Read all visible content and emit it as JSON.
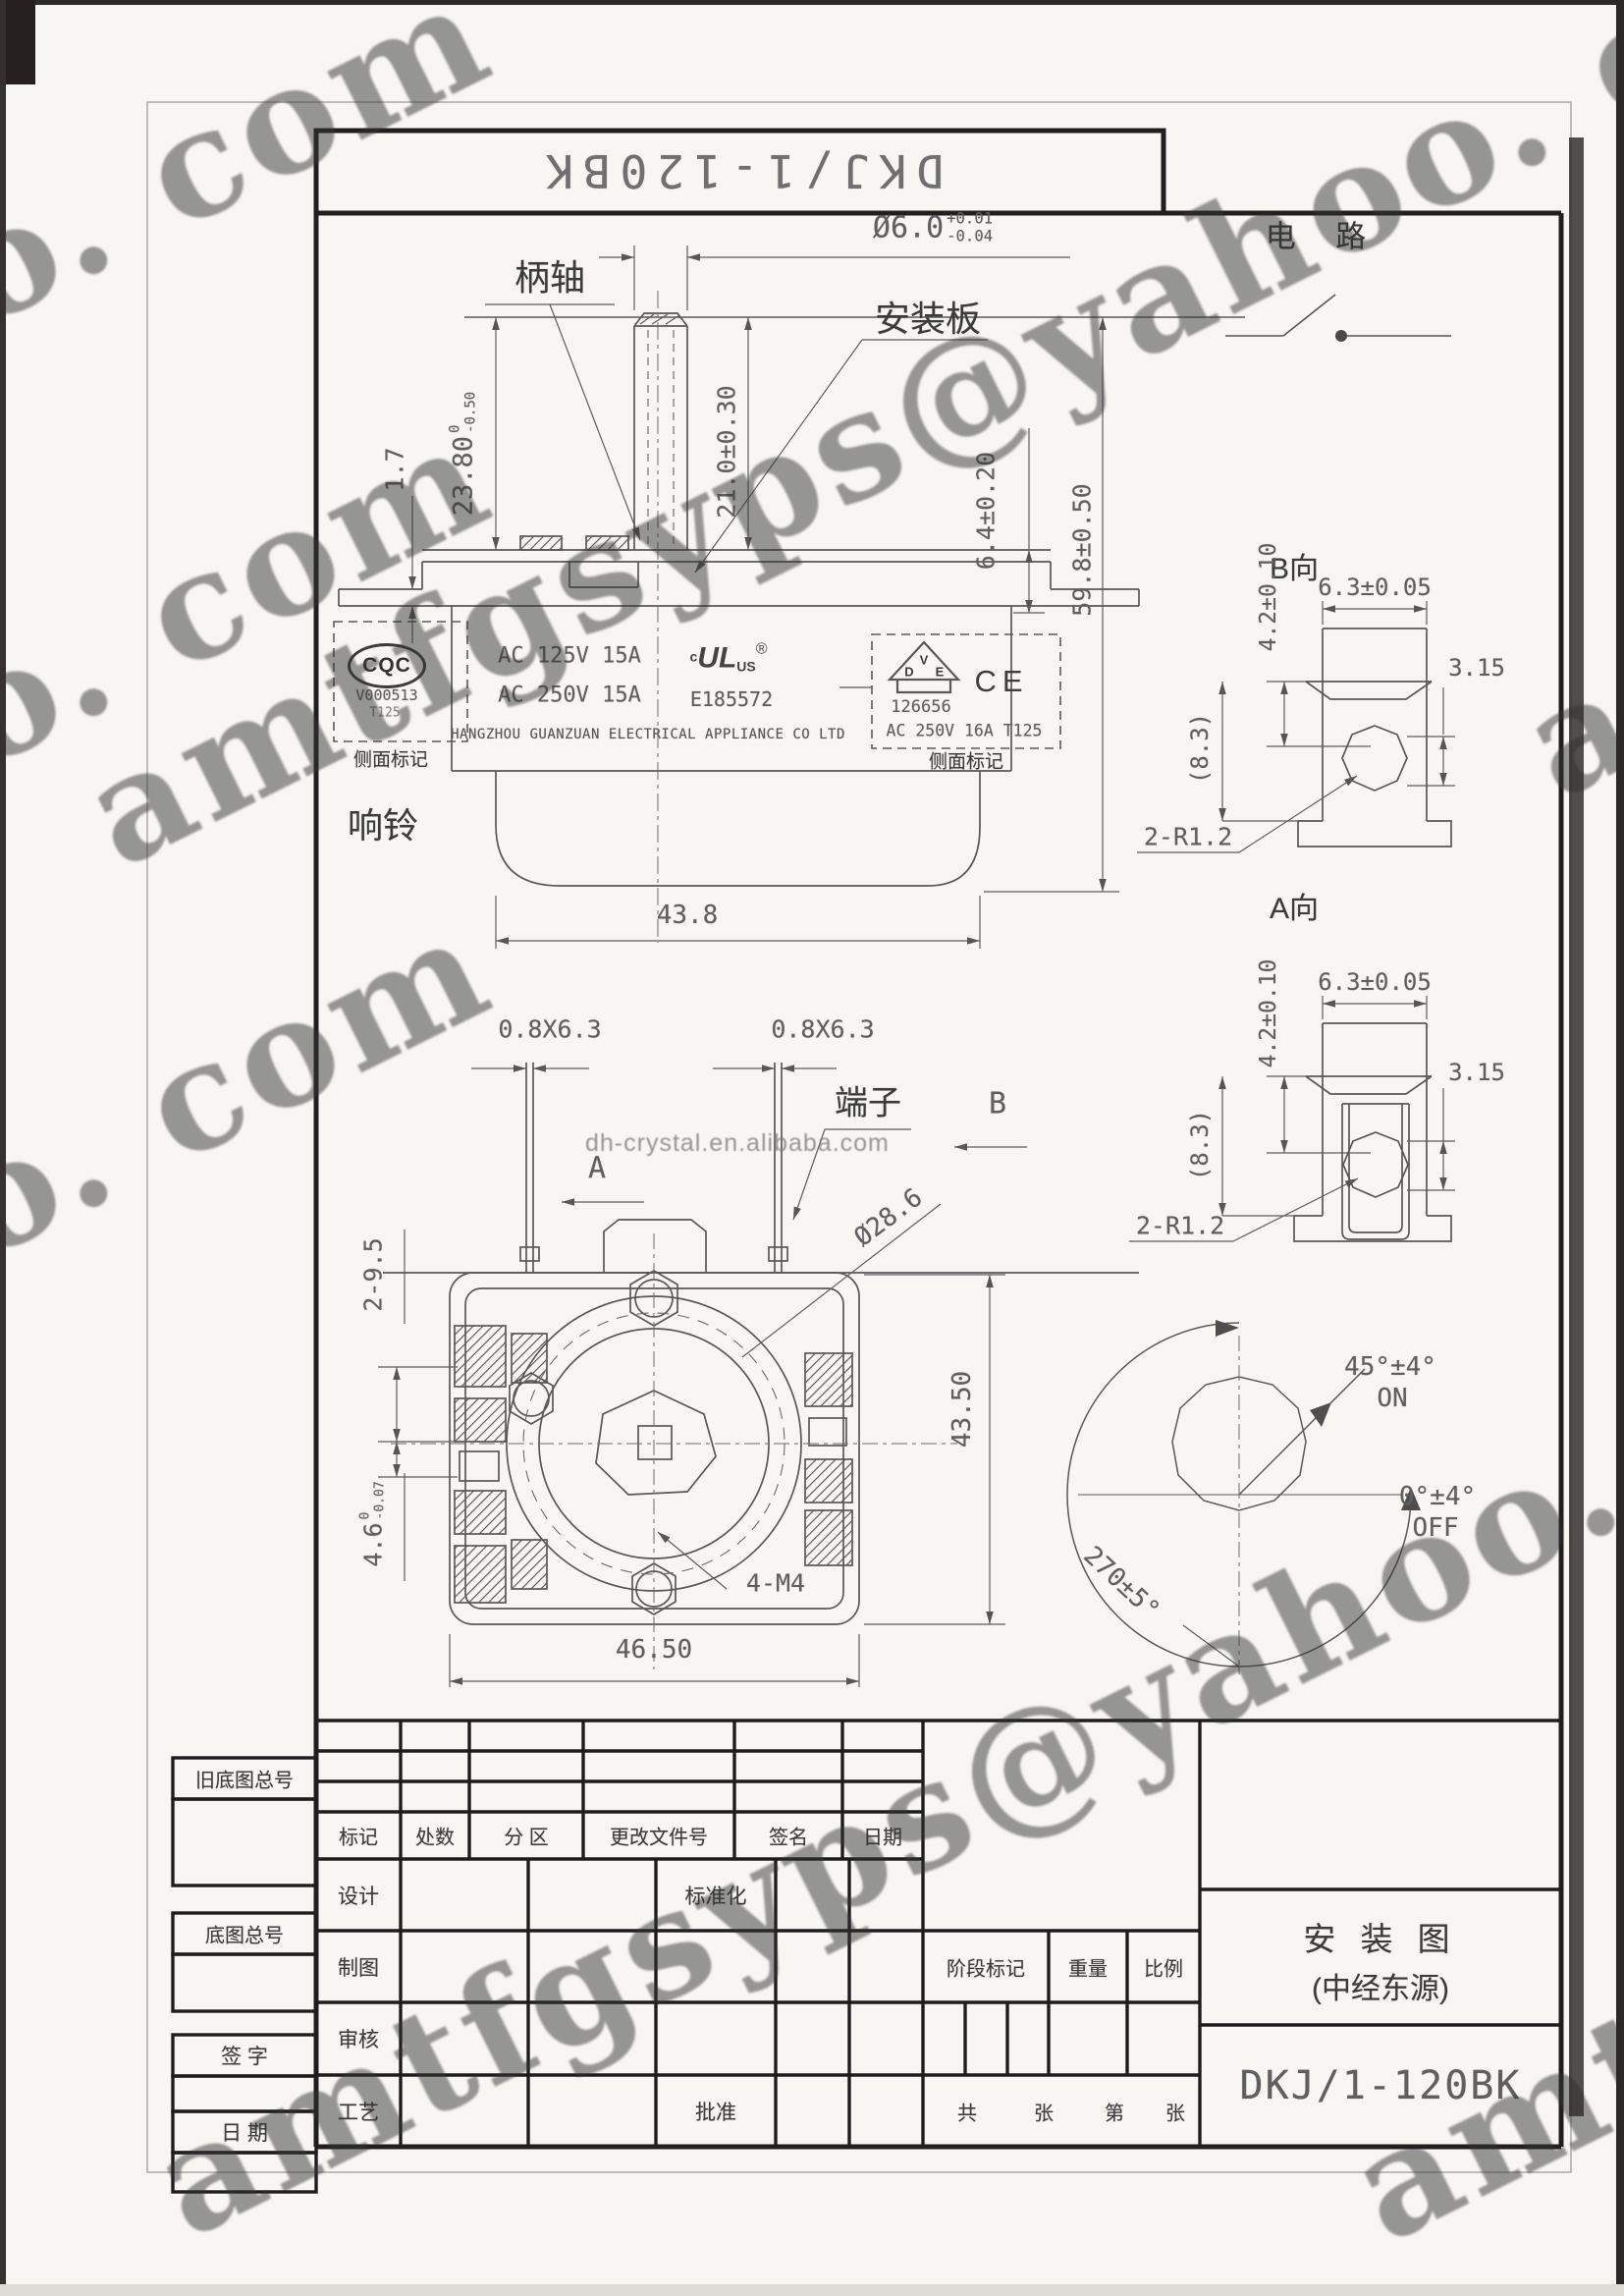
{
  "watermark": {
    "email": "amtfgsyps@yahoo. com",
    "alibaba": "dh-crystal.en.alibaba.com"
  },
  "top_bar": {
    "part_no": "DKJ/1-120BK"
  },
  "circuit": {
    "label": "电  路"
  },
  "side_view": {
    "handle_shaft_label": "柄轴",
    "mounting_plate_label": "安装板",
    "bell_label": "响铃",
    "shaft_dia": {
      "main": "Ø6.0",
      "plus": "+0.01",
      "minus": "-0.04"
    },
    "shaft_len": {
      "main": "23.80",
      "plus": "0",
      "minus": "-0.50"
    },
    "plate_thickness": "1.7",
    "dim_21": "21.0±0.30",
    "dim_64": "6.4±0.20",
    "dim_598": "59.8±0.50",
    "dim_438": "43.8",
    "cqc": {
      "logo": "CQC",
      "cert_no": "V000513",
      "t_rating": "T125",
      "side_mark_label": "侧面标记"
    },
    "ratings": {
      "line1": "AC 125V 15A",
      "line2": "AC 250V 15A"
    },
    "ul": {
      "c": "c",
      "logo": "UL",
      "us": "US",
      "reg": "®",
      "file_no": "E185572"
    },
    "manufacturer": "HANGZHOU GUANZUAN ELECTRICAL APPLIANCE CO LTD",
    "vde": {
      "d": "D",
      "v": "V",
      "e": "E",
      "cert_no": "126656",
      "ce": "CE",
      "rating": "AC 250V 16A T125",
      "side_mark_label": "侧面标记"
    }
  },
  "bottom_view": {
    "terminal_dim_left": "0.8X6.3",
    "terminal_dim_right": "0.8X6.3",
    "terminal_label": "端子",
    "view_a": "A",
    "view_b": "B",
    "dim_2_95": "2-9.5",
    "dim_46": {
      "main": "4.6",
      "plus": "0",
      "minus": "-0.07"
    },
    "dim_dia286": "Ø28.6",
    "dim_435": "43.50",
    "dim_4m4": "4-M4",
    "dim_465": "46.50"
  },
  "terminal_detail_b": {
    "title": "B向",
    "dim_42": "4.2±0.10",
    "dim_63": "6.3±0.05",
    "dim_315": "3.15",
    "dim_83": "(8.3)",
    "dim_r": "2-R1.2"
  },
  "terminal_detail_a": {
    "title": "A向",
    "dim_42": "4.2±0.10",
    "dim_63": "6.3±0.05",
    "dim_315": "3.15",
    "dim_83": "(8.3)",
    "dim_r": "2-R1.2"
  },
  "rotation_diagram": {
    "on_angle": "45°±4°",
    "on_label": "ON",
    "off_angle": "0°±4°",
    "off_label": "OFF",
    "travel": "270±5°"
  },
  "title_block": {
    "old_base_no": "旧底图总号",
    "base_no": "底图总号",
    "signature": "签  字",
    "date_label": "日  期",
    "rev_headers": [
      "标记",
      "处数",
      "分  区",
      "更改文件号",
      "签名",
      "日期"
    ],
    "roles": {
      "design": "设计",
      "draft": "制图",
      "check": "审核",
      "process": "工艺",
      "standardize": "标准化",
      "approve": "批准"
    },
    "stage_mark": "阶段标记",
    "weight": "重量",
    "scale": "比例",
    "sheet_total": "共",
    "sheet_zhang1": "张",
    "sheet_no": "第",
    "sheet_zhang2": "张",
    "drawing_title_1": "安 装 图",
    "drawing_title_2": "(中经东源)",
    "part_no": "DKJ/1-120BK"
  }
}
